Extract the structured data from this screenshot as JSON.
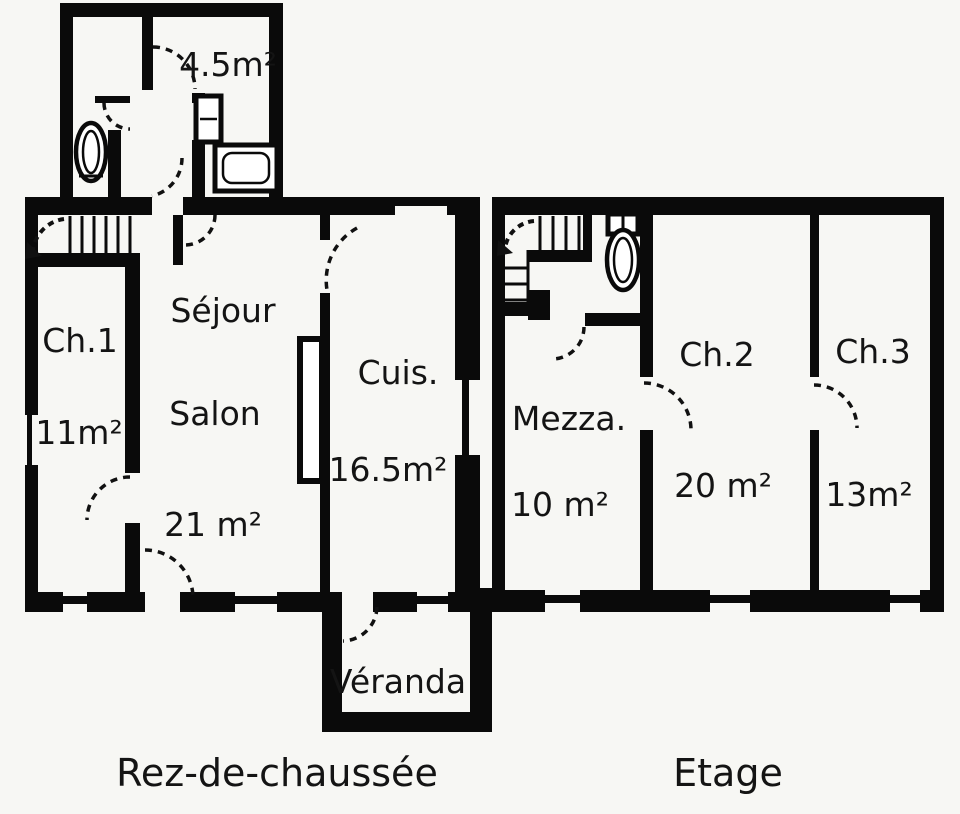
{
  "title": "House floor plan",
  "colors": {
    "wall": "#0a0a0a",
    "background": "#f7f7f4",
    "text": "#141414"
  },
  "ground_floor": {
    "caption": "Rez-de-chaussée",
    "bathroom_area": "4.5m²",
    "ch1_label": "Ch.1",
    "ch1_area": "11m²",
    "sejour_label": "Séjour",
    "salon_label": "Salon",
    "salon_area": "21 m²",
    "kitchen_label": "Cuis.",
    "kitchen_area": "16.5m²",
    "veranda_label": "Véranda"
  },
  "upper_floor": {
    "caption": "Etage",
    "mezzanine_label": "Mezza.",
    "mezzanine_area": "10 m²",
    "ch2_label": "Ch.2",
    "ch2_area": "20 m²",
    "ch3_label": "Ch.3",
    "ch3_area": "13m²"
  }
}
